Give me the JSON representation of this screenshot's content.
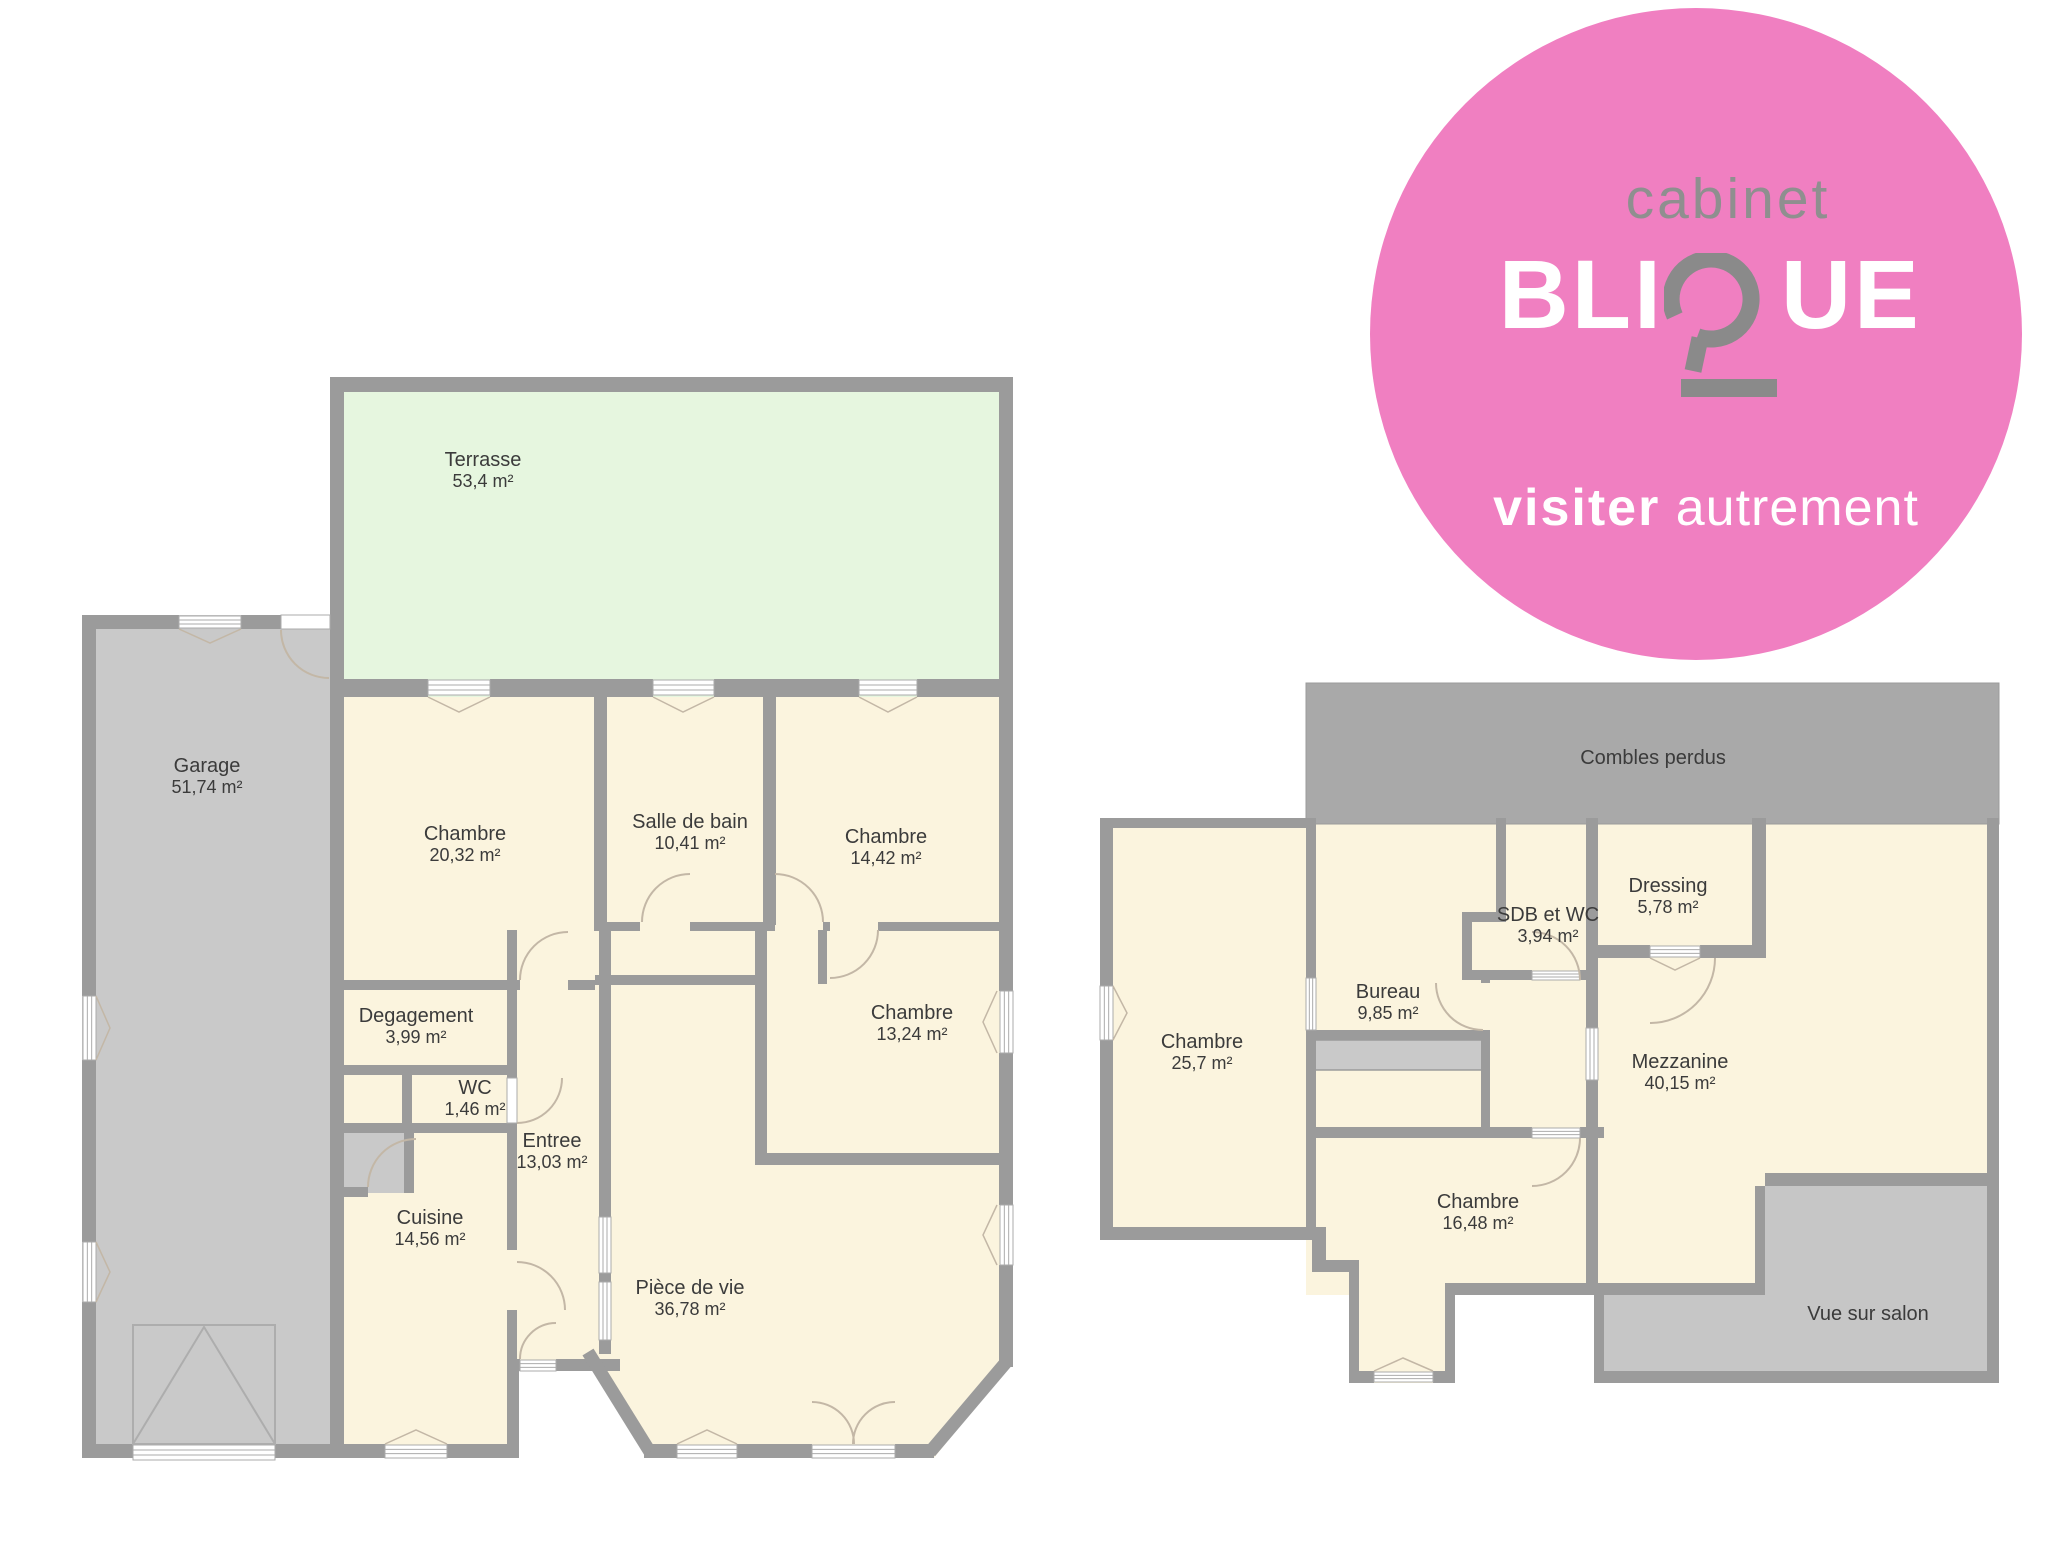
{
  "logo": {
    "cabinet": "cabinet",
    "name_start": "BLI",
    "name_end": "UE",
    "tagline_bold": "visiter",
    "tagline_light": "autrement",
    "colors": {
      "pink": "#f07fc1",
      "cabinet_gray": "#8f8f8f",
      "q_gray": "#8a8a8a",
      "white": "#ffffff"
    }
  },
  "plan_colors": {
    "wall": "#9b9b9b",
    "room_fill": "#fbf4de",
    "terrace_fill": "#e6f6df",
    "garage_fill": "#c9c9c9",
    "combles_fill": "#a9a9a9",
    "vue_fill": "#c6c6c6",
    "door_arc": "#c3b7a6",
    "label_text": "#3b3b3b"
  },
  "ground_floor": {
    "rooms": [
      {
        "name": "Terrasse",
        "area": "53,4 m²"
      },
      {
        "name": "Garage",
        "area": "51,74 m²"
      },
      {
        "name": "Chambre",
        "area": "20,32 m²"
      },
      {
        "name": "Salle de bain",
        "area": "10,41 m²"
      },
      {
        "name": "Chambre",
        "area": "14,42 m²"
      },
      {
        "name": "Chambre",
        "area": "13,24 m²"
      },
      {
        "name": "Degagement",
        "area": "3,99 m²"
      },
      {
        "name": "WC",
        "area": "1,46 m²"
      },
      {
        "name": "Entree",
        "area": "13,03 m²"
      },
      {
        "name": "Cuisine",
        "area": "14,56 m²"
      },
      {
        "name": "Pièce de vie",
        "area": "36,78 m²"
      }
    ]
  },
  "upper_floor": {
    "rooms": [
      {
        "name": "Combles perdus",
        "area": ""
      },
      {
        "name": "Chambre",
        "area": "25,7 m²"
      },
      {
        "name": "Bureau",
        "area": "9,85 m²"
      },
      {
        "name": "SDB et WC",
        "area": "3,94 m²"
      },
      {
        "name": "Dressing",
        "area": "5,78 m²"
      },
      {
        "name": "Mezzanine",
        "area": "40,15 m²"
      },
      {
        "name": "Chambre",
        "area": "16,48 m²"
      },
      {
        "name": "Vue sur salon",
        "area": ""
      }
    ]
  }
}
